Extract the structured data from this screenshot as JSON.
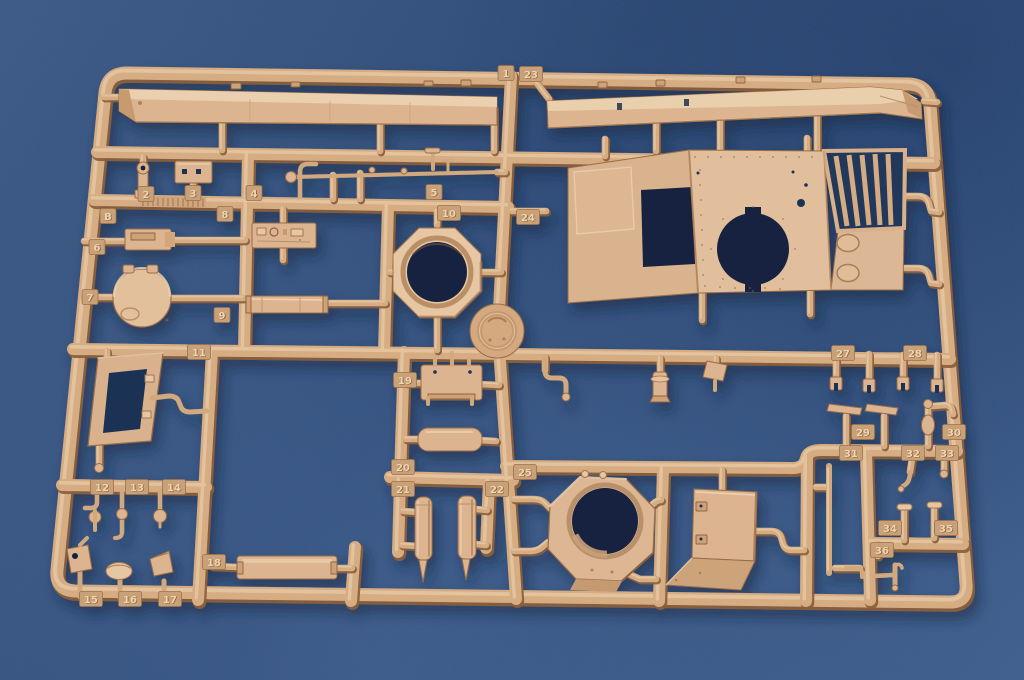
{
  "sprue": {
    "sprue_letter": "B",
    "tags": [
      {
        "label": "1",
        "x": 506,
        "y": 73
      },
      {
        "label": "2",
        "x": 146,
        "y": 194
      },
      {
        "label": "3",
        "x": 193,
        "y": 193
      },
      {
        "label": "4",
        "x": 254,
        "y": 193
      },
      {
        "label": "5",
        "x": 434,
        "y": 192
      },
      {
        "label": "6",
        "x": 97,
        "y": 247
      },
      {
        "label": "7",
        "x": 90,
        "y": 297
      },
      {
        "label": "8",
        "x": 225,
        "y": 214
      },
      {
        "label": "9",
        "x": 222,
        "y": 315
      },
      {
        "label": "10",
        "x": 449,
        "y": 213
      },
      {
        "label": "11",
        "x": 199,
        "y": 352
      },
      {
        "label": "12",
        "x": 102,
        "y": 487
      },
      {
        "label": "13",
        "x": 137,
        "y": 487
      },
      {
        "label": "14",
        "x": 174,
        "y": 487
      },
      {
        "label": "15",
        "x": 91,
        "y": 599
      },
      {
        "label": "16",
        "x": 130,
        "y": 599
      },
      {
        "label": "17",
        "x": 170,
        "y": 599
      },
      {
        "label": "18",
        "x": 214,
        "y": 562
      },
      {
        "label": "19",
        "x": 405,
        "y": 380
      },
      {
        "label": "20",
        "x": 403,
        "y": 467
      },
      {
        "label": "21",
        "x": 403,
        "y": 489
      },
      {
        "label": "22",
        "x": 497,
        "y": 489
      },
      {
        "label": "23",
        "x": 531,
        "y": 74
      },
      {
        "label": "24",
        "x": 528,
        "y": 217
      },
      {
        "label": "25",
        "x": 525,
        "y": 472
      },
      {
        "label": "27",
        "x": 843,
        "y": 353
      },
      {
        "label": "28",
        "x": 915,
        "y": 353
      },
      {
        "label": "29",
        "x": 863,
        "y": 432
      },
      {
        "label": "30",
        "x": 954,
        "y": 432
      },
      {
        "label": "31",
        "x": 851,
        "y": 453
      },
      {
        "label": "32",
        "x": 913,
        "y": 453
      },
      {
        "label": "33",
        "x": 947,
        "y": 453
      },
      {
        "label": "34",
        "x": 890,
        "y": 528
      },
      {
        "label": "35",
        "x": 946,
        "y": 528
      },
      {
        "label": "36",
        "x": 882,
        "y": 550
      },
      {
        "label": "B",
        "x": 108,
        "y": 216
      }
    ]
  },
  "palette": {
    "plastic": "#d6ac83",
    "plastic_highlight": "#f0d9ba",
    "plastic_shadow": "#8a5e3c",
    "background_blue": "#31507e",
    "background_dark": "#1c3763",
    "background_light": "#49699a",
    "through_hole": "#15243f"
  }
}
